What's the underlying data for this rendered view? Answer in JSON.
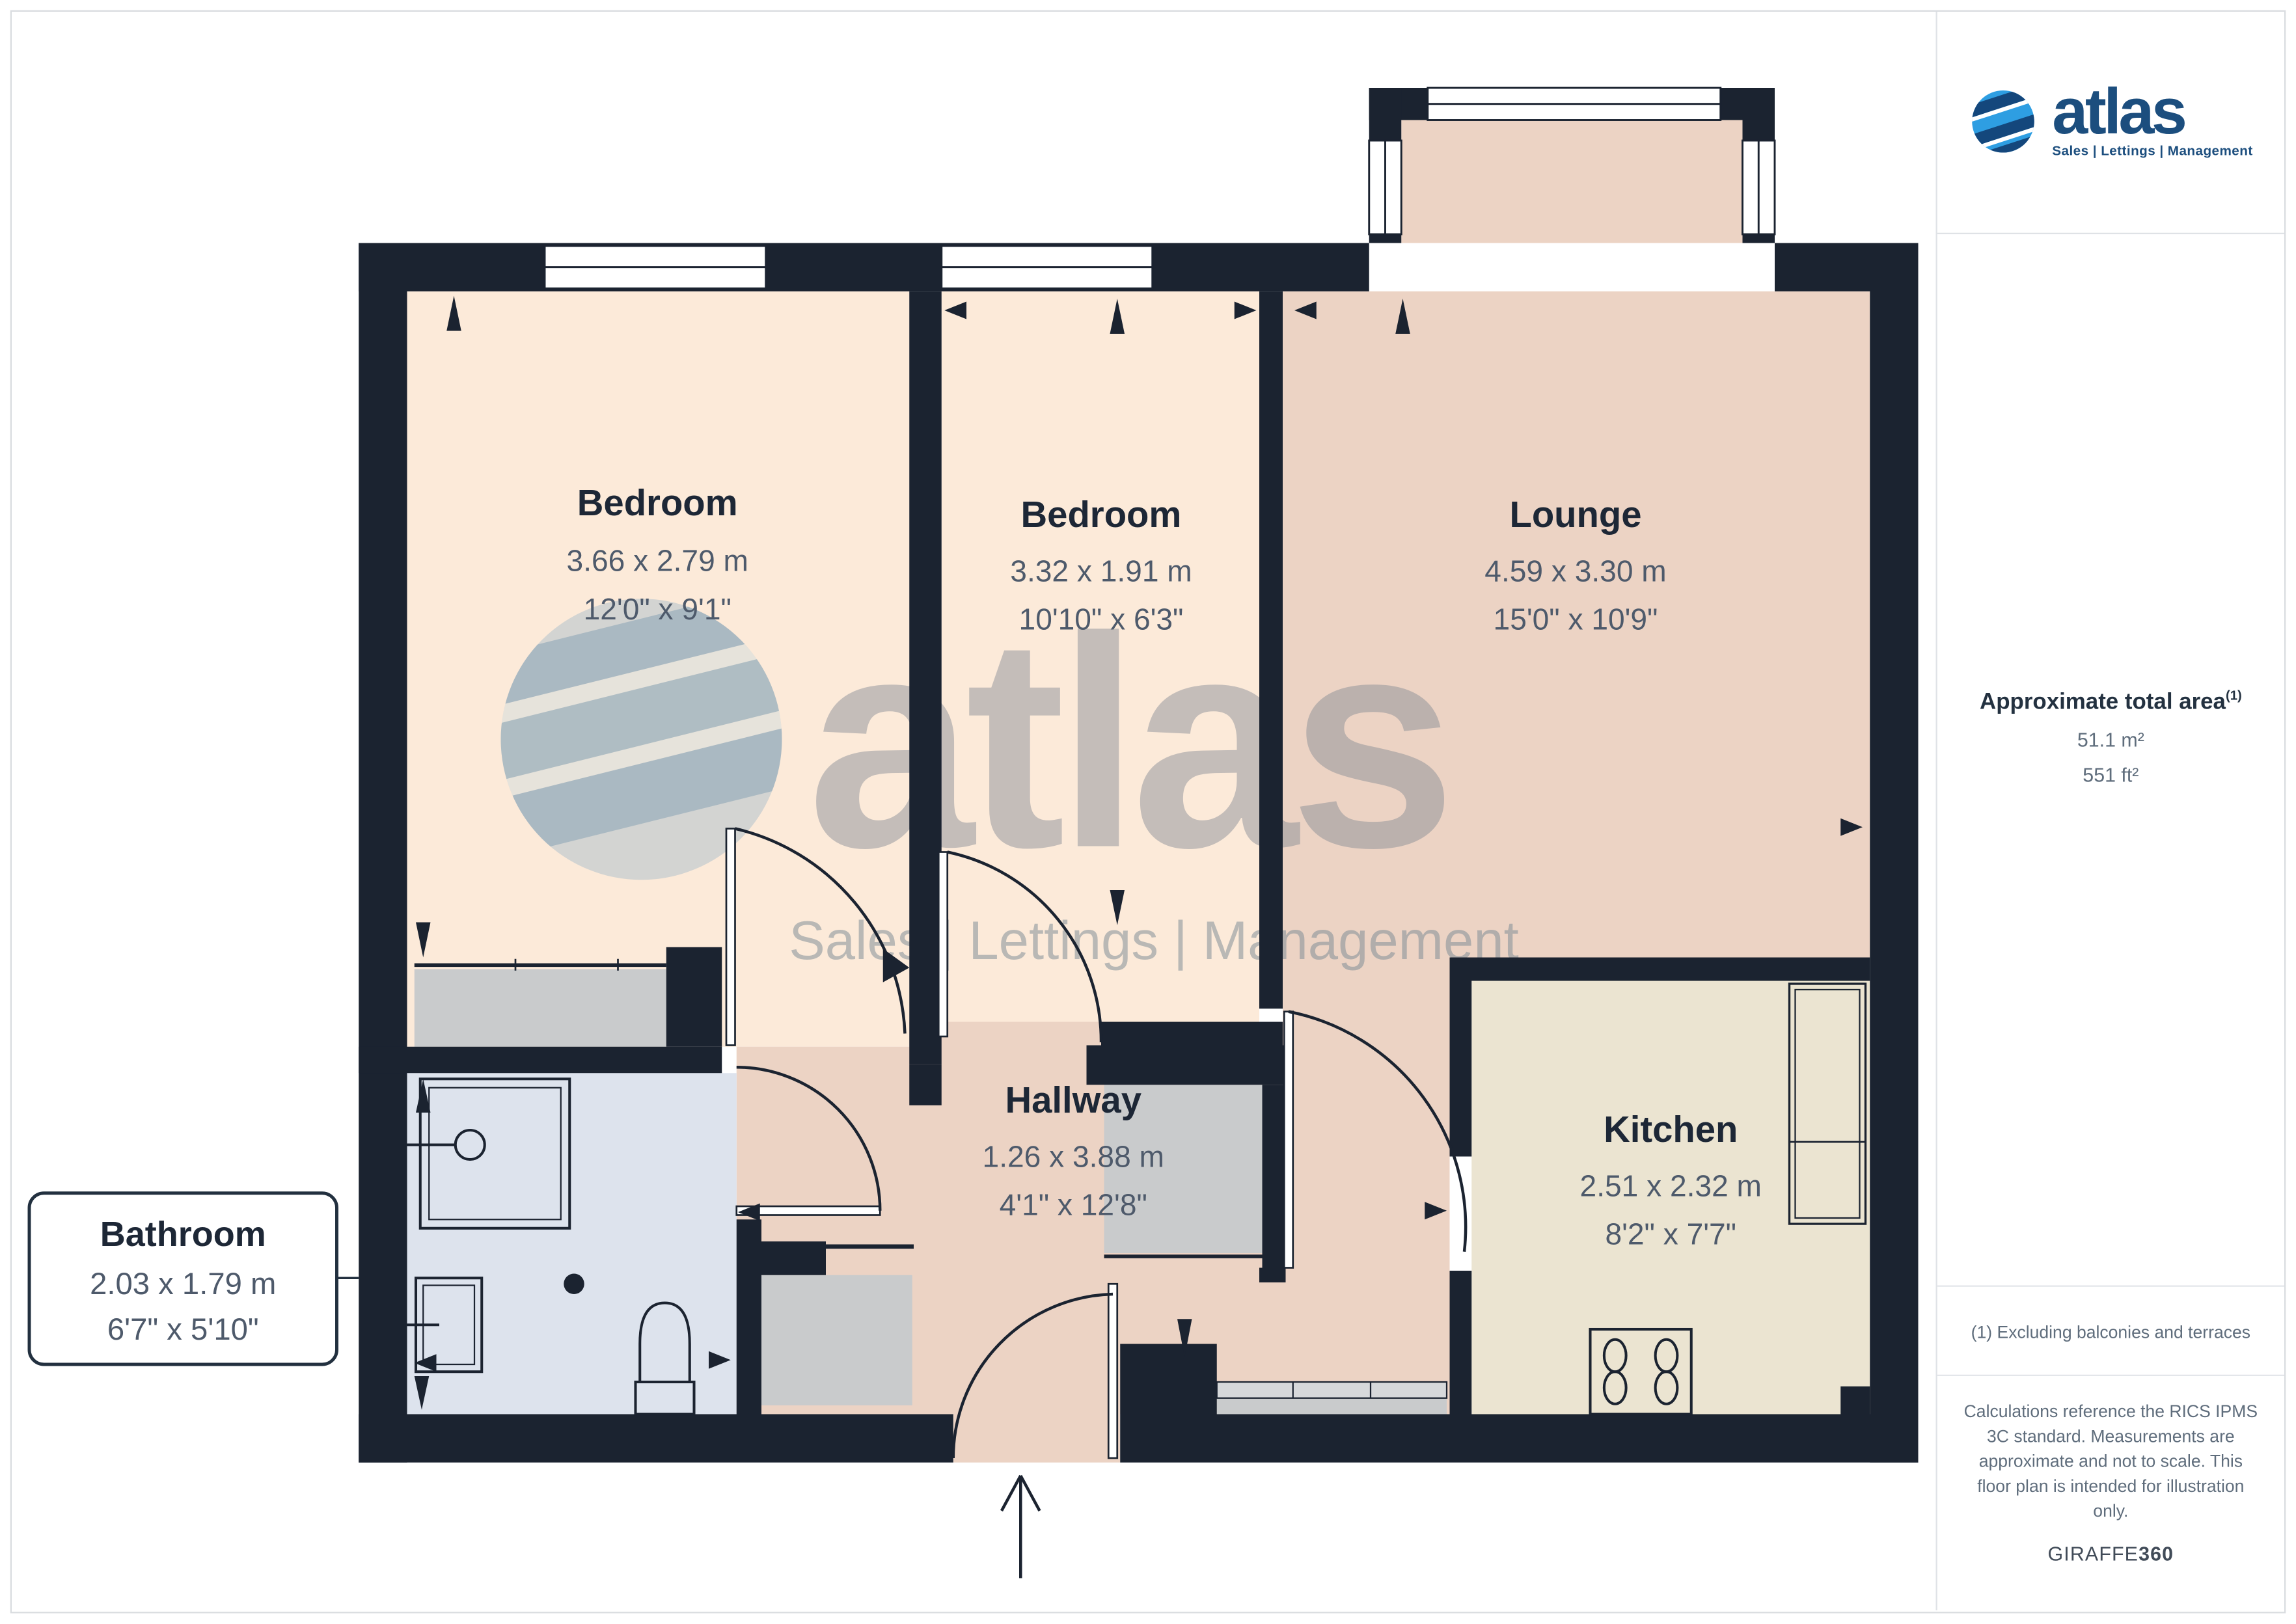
{
  "rooms": [
    {
      "name": "Bedroom",
      "dims_m": "3.66 x 2.79 m",
      "dims_ft": "12'0\" x 9'1\""
    },
    {
      "name": "Bedroom",
      "dims_m": "3.32 x 1.91 m",
      "dims_ft": "10'10\" x 6'3\""
    },
    {
      "name": "Lounge",
      "dims_m": "4.59 x 3.30 m",
      "dims_ft": "15'0\" x 10'9\""
    },
    {
      "name": "Hallway",
      "dims_m": "1.26 x 3.88 m",
      "dims_ft": "4'1\" x 12'8\""
    },
    {
      "name": "Kitchen",
      "dims_m": "2.51 x 2.32 m",
      "dims_ft": "8'2\" x 7'7\""
    },
    {
      "name": "Bathroom",
      "dims_m": "2.03 x 1.79 m",
      "dims_ft": "6'7\" x 5'10\""
    }
  ],
  "logo": {
    "brand": "atlas",
    "slogan": "Sales | Lettings | Management"
  },
  "watermark": {
    "brand": "atlas",
    "slogan": "Sales | Lettings | Management"
  },
  "sidebar": {
    "area_title": "Approximate total area",
    "area_sup": "(1)",
    "area_m": "51.1 m²",
    "area_ft": "551 ft²",
    "footnote": "(1) Excluding balconies and terraces",
    "note_lines": [
      "Calculations reference the RICS IPMS",
      "3C standard. Measurements are",
      "approximate and not to scale. This",
      "floor plan is intended for illustration",
      "only."
    ],
    "brand_word": "GIRAFFE",
    "brand_num": "360"
  },
  "colors": {
    "wall": "#1b2330",
    "bedroom": "#fcead9",
    "lounge_hall": "#ecd3c4",
    "kitchen": "#ebe4d1",
    "bathroom": "#dde3ed",
    "furniture_grey": "#c9cbcc",
    "dim_text": "#4e5a6b",
    "title_text": "#1d2736",
    "logo_navy": "#1c4e7e",
    "logo_blue": "#2e9ee2"
  }
}
